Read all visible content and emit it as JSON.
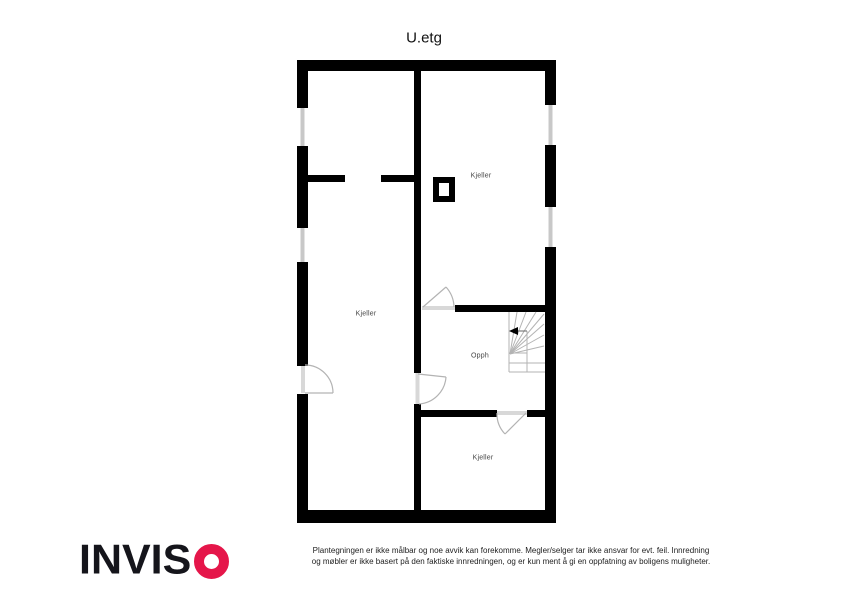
{
  "title": "U.etg",
  "rooms": {
    "kjeller_top": "Kjeller",
    "kjeller_left": "Kjeller",
    "kjeller_bottom": "Kjeller",
    "opph": "Opph"
  },
  "branding": {
    "logo_text": "INVIS",
    "logo_o": "O",
    "logo_o_color": "#e5164a",
    "logo_text_color": "#15151b"
  },
  "disclaimer": {
    "line1": "Plantegningen er ikke målbar og noe avvik kan forekomme. Megler/selger tar ikke ansvar for evt. feil. Innredning",
    "line2": "og møbler er ikke basert på den faktiske innredningen, og er kun ment å gi en oppfatning av boligens muligheter."
  },
  "colors": {
    "wall": "#000000",
    "window": "#c8c8c8",
    "door_line": "#b3b3b3",
    "stair_line": "#b3b3b3",
    "room_label": "#454545"
  }
}
